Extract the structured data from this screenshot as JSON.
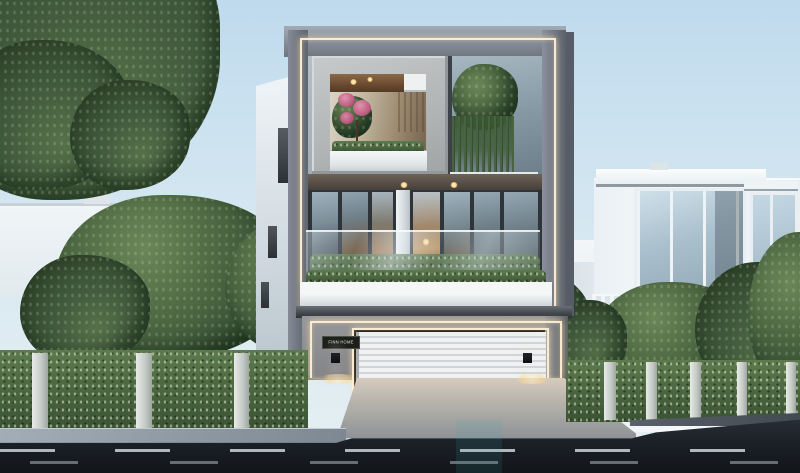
{
  "scene": {
    "sign": {
      "label": "FINN HOME"
    },
    "palette": {
      "sky_top": "#bfdaed",
      "sky_horizon": "#e6eff3",
      "facade_white": "#eef3f6",
      "frame_gray": "#7d848f",
      "concrete_frame": "#b7bbbc",
      "led_warm": "#ffe9c4",
      "garage_wall": "#8f9094",
      "roller_door": "#e9ecee",
      "hedge_green": "#4a613e",
      "tree_green": "#47613d",
      "road_asphalt": "#1b2026",
      "interior_warm": "#c0905c",
      "flower_pink": "#c96a8c"
    }
  }
}
